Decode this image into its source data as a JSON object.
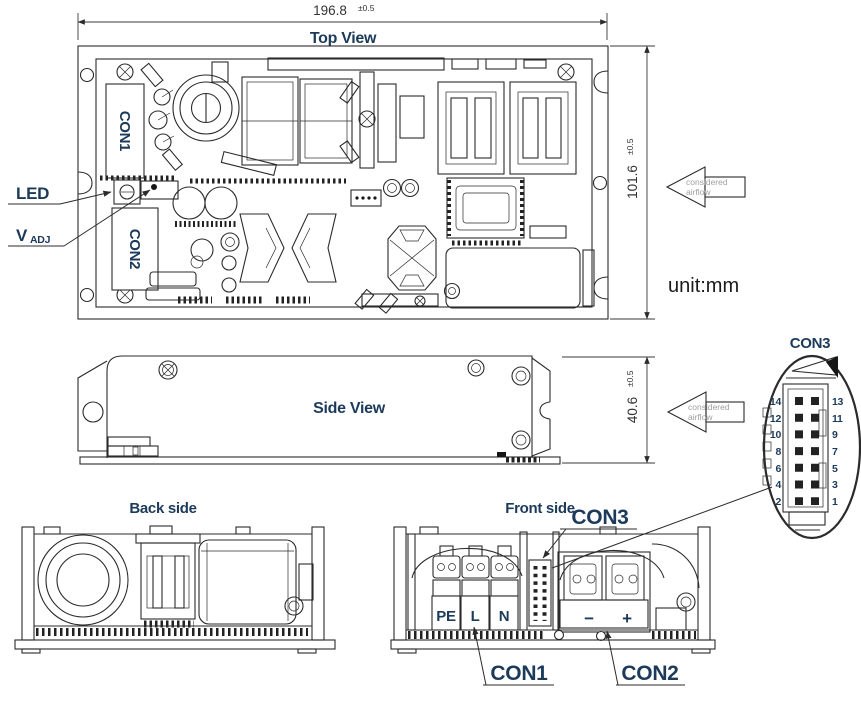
{
  "unit_label": "unit:mm",
  "colors": {
    "label_navy": "#1c3a5a",
    "line": "#2b2b2b",
    "airflow_gray": "#9f9f9f"
  },
  "dims": {
    "width": {
      "value": "196.8",
      "tol": "±0.5"
    },
    "height": {
      "value": "101.6",
      "tol": "±0.5"
    },
    "side_height": {
      "value": "40.6",
      "tol": "±0.5"
    }
  },
  "airflow": {
    "line1": "considered",
    "line2": "airflow"
  },
  "views": {
    "top": {
      "title": "Top View"
    },
    "side": {
      "title": "Side View"
    },
    "back": {
      "title": "Back side"
    },
    "front": {
      "title": "Front side"
    }
  },
  "top_view": {
    "con1_box": "CON1",
    "con2_box": "CON2",
    "led_label": "LED",
    "vadj_main": "V",
    "vadj_sub": "ADJ"
  },
  "front_view": {
    "con1_label": "CON1",
    "con2_label": "CON2",
    "con3_label": "CON3",
    "terminal_pe": "PE",
    "terminal_l": "L",
    "terminal_n": "N",
    "minus": "−",
    "plus": "+"
  },
  "con3_detail": {
    "title": "CON3",
    "left_pins": [
      "14",
      "12",
      "10",
      "8",
      "6",
      "4",
      "2"
    ],
    "right_pins": [
      "13",
      "11",
      "9",
      "7",
      "5",
      "3",
      "1"
    ]
  }
}
